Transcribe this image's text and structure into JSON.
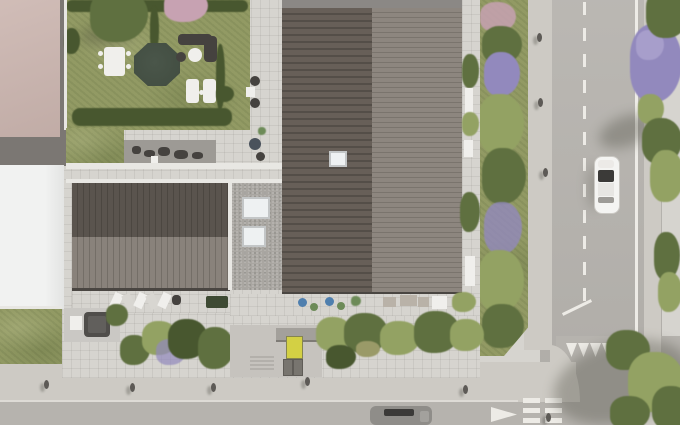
{
  "meta": {
    "description": "Top-down aerial architectural rendering of a residential building complex with rooftop garden, metal roofs, terraces, streets, vehicles and pedestrians",
    "view": "bird's-eye top-down",
    "canvas": "680x425"
  },
  "colors": {
    "tile": "#d6d4cf",
    "tile_line": "rgba(100,95,88,0.10)",
    "sidewalk": "#cdcac4",
    "asphalt": "#b6b3ae",
    "marking": "#edebe6",
    "grass": "#929a64",
    "grass_deep": "#6f7d48",
    "hedge": "#48572f",
    "canopy": "#5f7040",
    "canopy_light": "#93a263",
    "purple_bloom": "#9289bd",
    "purple_bloom_light": "#a79ecb",
    "pink_bloom": "#c7a2b2",
    "pond": "#414c40",
    "pink_roof": "#cbb5af",
    "dark_path": "#7b7773",
    "white_roof": "#f1f2f1",
    "roof_dark_a": "#675f58",
    "roof_dark_b": "#544e48",
    "roof_light_a": "#8d867f",
    "roof_light_b": "#7a746d",
    "left_roof_top_a": "#5a544e",
    "left_roof_top_b": "#4c4741",
    "left_roof_bot_a": "#89827b",
    "left_roof_bot_b": "#746e67",
    "gravel": "#a9a6a1",
    "skylight": "#eef1f2",
    "parapet": "#e8e7e3",
    "terrace_gray": "#9d9a95",
    "furniture_dark": "#45423f",
    "furniture_white": "#f0efec",
    "chair_blue": "#4f7fae",
    "chair_green": "#6d8b58",
    "table_wood": "#b9b2a8",
    "door_yellow": "#d3d044",
    "car_white": "#f4f4f2",
    "car_gray": "#8f8d89",
    "car_dark": "#504e4b",
    "glass_dark": "#3b3a38",
    "pedestrian": "#5d5a56",
    "planter_green": "#3e4a33",
    "pavement_entry": "#c6c3be"
  },
  "scene": {
    "buildings": [
      {
        "name": "main-building",
        "roof": "dark standing-seam metal in two tones with skylight",
        "features": [
          "roof-parapet",
          "east-balcony-with-planters",
          "south-terrace-with-colored-chairs",
          "gravel-roof-section-with-two-skylights"
        ]
      },
      {
        "name": "west-wing",
        "roof": "standing-seam metal, darker upper band and lighter lower band",
        "features": [
          "south-terrace-with-loungers"
        ]
      },
      {
        "name": "rooftop-garden",
        "features": [
          "dark-pond",
          "white-dining-table",
          "dark-lounge-set",
          "two-sun-loungers",
          "perimeter-hedges",
          "trees",
          "gray-patio-with-furniture"
        ]
      },
      {
        "name": "neighbor-building-north",
        "roof": "pink-beige flat roof"
      },
      {
        "name": "neighbor-building-south",
        "roof": "white flat roof"
      }
    ],
    "streets": {
      "vertical_street": {
        "markings": [
          "dashed-center-line",
          "solid-right-edge-line",
          "yield-shark-teeth-row"
        ],
        "vehicles": [
          "white-car-southbound"
        ]
      },
      "horizontal_street": {
        "markings": [
          "give-way-arrow",
          "ladder-crossing-bars",
          "edge-line"
        ],
        "vehicles": [
          "gray-car"
        ]
      }
    },
    "ground_level": {
      "features": [
        "lawn",
        "carport-with-dark-car",
        "entry-court",
        "yellow-entrance-door",
        "utility-boxes",
        "entry-steps",
        "hedge-band",
        "street-green-strip-with-flowering-bushes",
        "purple-blooming-tree",
        "large-trees-with-shadows"
      ]
    },
    "pedestrians_visible": 9
  }
}
